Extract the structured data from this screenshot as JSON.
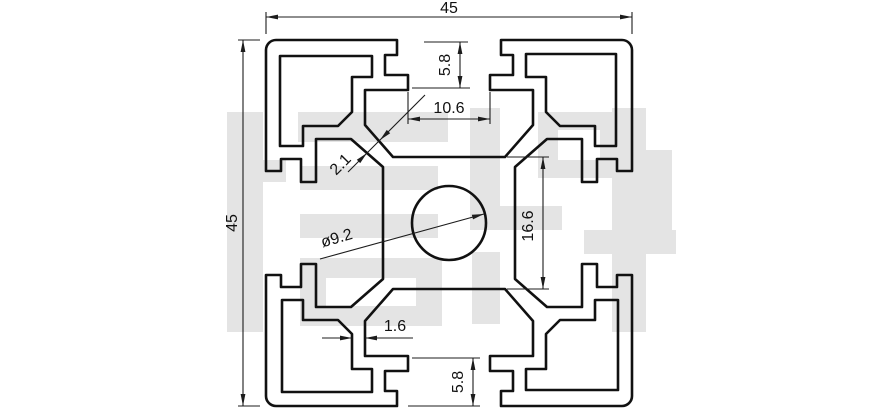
{
  "title": "45x45 aluminium extrusion profile cross-section technical drawing",
  "watermark": {
    "text": "信牌",
    "color": "#e4e4e4",
    "rects": [
      [
        227,
        112,
        36,
        220
      ],
      [
        240,
        160,
        46,
        22
      ],
      [
        298,
        112,
        150,
        30
      ],
      [
        300,
        166,
        138,
        24
      ],
      [
        300,
        214,
        138,
        24
      ],
      [
        300,
        258,
        142,
        68
      ],
      [
        470,
        108,
        30,
        122
      ],
      [
        470,
        206,
        92,
        24
      ],
      [
        472,
        252,
        28,
        72
      ],
      [
        538,
        112,
        82,
        66
      ],
      [
        584,
        230,
        92,
        24
      ],
      [
        612,
        108,
        34,
        224
      ],
      [
        646,
        150,
        26,
        96
      ]
    ],
    "holes": [
      [
        326,
        278,
        90,
        28
      ],
      [
        558,
        130,
        42,
        30
      ]
    ]
  },
  "drawing": {
    "stroke_color": "#111111",
    "stroke_width": 2.6,
    "dim_color": "#1c1c1c",
    "dim_stroke_width": 1.1,
    "center": [
      449,
      223
    ],
    "corner_radius": 10,
    "bore_radius": 37,
    "profile_quarter_points": [
      [
        276,
        40
      ],
      [
        397,
        40
      ],
      [
        397,
        55
      ],
      [
        385,
        55
      ],
      [
        385,
        75
      ],
      [
        408,
        75
      ],
      [
        408,
        90
      ],
      [
        365,
        90
      ],
      [
        365,
        125
      ],
      [
        393,
        157
      ],
      [
        505,
        157
      ],
      [
        533,
        125
      ],
      [
        533,
        90
      ],
      [
        490,
        90
      ],
      [
        490,
        75
      ],
      [
        513,
        75
      ],
      [
        513,
        55
      ],
      [
        501,
        55
      ],
      [
        501,
        40
      ],
      [
        622,
        40
      ]
    ],
    "corner_arc_from": [
      622,
      40
    ],
    "corner_hole_points": [
      [
        280,
        56
      ],
      [
        372,
        56
      ],
      [
        372,
        77
      ],
      [
        352,
        77
      ],
      [
        352,
        112
      ],
      [
        338,
        126
      ],
      [
        303,
        126
      ],
      [
        303,
        146
      ],
      [
        280,
        146
      ]
    ]
  },
  "dimensions": {
    "lines": [
      [
        266,
        34,
        266,
        12
      ],
      [
        632,
        34,
        632,
        12
      ],
      [
        266,
        17,
        632,
        17
      ],
      [
        260,
        40,
        238,
        40
      ],
      [
        260,
        406,
        238,
        406
      ],
      [
        243,
        40,
        243,
        406
      ],
      [
        424,
        42,
        468,
        42
      ],
      [
        412,
        88,
        470,
        88
      ],
      [
        460,
        42,
        460,
        88
      ],
      [
        408,
        92,
        408,
        124
      ],
      [
        490,
        92,
        490,
        124
      ],
      [
        408,
        119,
        490,
        119
      ],
      [
        348,
        172,
        425,
        95
      ],
      [
        320,
        259,
        484,
        214
      ],
      [
        507,
        157,
        549,
        157
      ],
      [
        507,
        289,
        549,
        289
      ],
      [
        543,
        157,
        543,
        289
      ],
      [
        322,
        338,
        352,
        338
      ],
      [
        365,
        338,
        413,
        338
      ],
      [
        412,
        358,
        480,
        358
      ],
      [
        408,
        406,
        480,
        406
      ],
      [
        473,
        358,
        473,
        406
      ]
    ],
    "arrows": [
      [
        266,
        17,
        180
      ],
      [
        632,
        17,
        0
      ],
      [
        243,
        40,
        -90
      ],
      [
        243,
        406,
        90
      ],
      [
        460,
        42,
        -90
      ],
      [
        460,
        88,
        90
      ],
      [
        408,
        119,
        180
      ],
      [
        490,
        119,
        0
      ],
      [
        380,
        140,
        135
      ],
      [
        367,
        153,
        -45
      ],
      [
        484,
        214,
        -15
      ],
      [
        543,
        157,
        -90
      ],
      [
        543,
        289,
        90
      ],
      [
        352,
        338,
        0
      ],
      [
        365,
        338,
        180
      ],
      [
        473,
        358,
        -90
      ],
      [
        473,
        406,
        90
      ]
    ],
    "labels": [
      {
        "text": "45",
        "x": 449,
        "y": 13,
        "rot": 0,
        "name": "dim-overall-width"
      },
      {
        "text": "45",
        "x": 237,
        "y": 223,
        "rot": -90,
        "name": "dim-overall-height"
      },
      {
        "text": "5.8",
        "x": 450,
        "y": 65,
        "rot": -90,
        "name": "dim-slot-depth-top"
      },
      {
        "text": "10.6",
        "x": 449,
        "y": 113,
        "rot": 0,
        "name": "dim-slot-width"
      },
      {
        "text": "2.1",
        "x": 344,
        "y": 168,
        "rot": -45,
        "name": "dim-web-thickness"
      },
      {
        "text": "ø9.2",
        "x": 338,
        "y": 243,
        "rot": -16,
        "name": "dim-bore-diameter"
      },
      {
        "text": "16.6",
        "x": 533,
        "y": 226,
        "rot": -90,
        "name": "dim-core-height"
      },
      {
        "text": "1.6",
        "x": 395,
        "y": 331,
        "rot": 0,
        "name": "dim-wall-thickness"
      },
      {
        "text": "5.8",
        "x": 463,
        "y": 382,
        "rot": -90,
        "name": "dim-slot-depth-bottom"
      }
    ]
  }
}
